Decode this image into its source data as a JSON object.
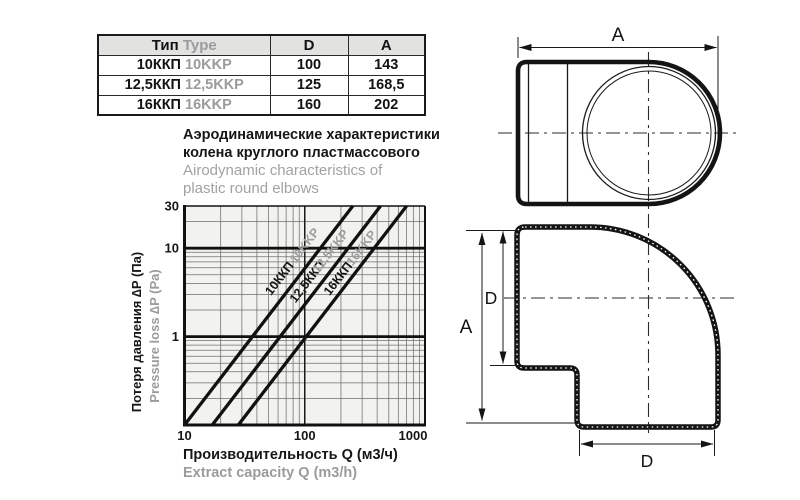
{
  "table": {
    "headers": {
      "type_ru": "Тип",
      "type_en": "Type",
      "d": "D",
      "a": "A"
    },
    "rows": [
      {
        "type_ru": "10ККП",
        "type_en": "10KKP",
        "d": "100",
        "a": "143"
      },
      {
        "type_ru": "12,5ККП",
        "type_en": "12,5KKP",
        "d": "125",
        "a": "168,5"
      },
      {
        "type_ru": "16ККП",
        "type_en": "16KKP",
        "d": "160",
        "a": "202"
      }
    ]
  },
  "title": {
    "ru_line1": "Аэродинамические характеристики",
    "ru_line2": "колена круглого пластмассового",
    "en_line1": "Airodynamic characteristics of",
    "en_line2": "plastic round elbows"
  },
  "chart_data": {
    "type": "line",
    "title_ru": "Аэродинамические характеристики колена круглого пластмассового",
    "title_en": "Airodynamic characteristics of plastic round elbows",
    "x_scale": "log",
    "y_scale": "log",
    "xlim": [
      10,
      1000
    ],
    "ylim": [
      0.1,
      30
    ],
    "x_ticks": [
      10,
      100,
      1000
    ],
    "y_ticks": [
      30,
      10,
      1
    ],
    "grid": "log minor gridlines on both axes, heavy rules at P=1 and P=10",
    "xlabel_ru": "Производительность Q (м3/ч)",
    "xlabel_en": "Extract capacity Q (m3/h)",
    "ylabel_ru": "Потеря давления ∆P (Па)",
    "ylabel_en": "Pressure loss ∆P (Pa)",
    "legend_position": "labels rotated along lines",
    "series": [
      {
        "name_ru": "10ККП",
        "name_en": "10KKP",
        "points": [
          [
            10,
            0.1
          ],
          [
            251,
            30
          ]
        ]
      },
      {
        "name_ru": "12,5ККП",
        "name_en": "12,5KKP",
        "points": [
          [
            17,
            0.1
          ],
          [
            427,
            30
          ]
        ]
      },
      {
        "name_ru": "16ККП",
        "name_en": "16KKP",
        "points": [
          [
            28,
            0.1
          ],
          [
            703,
            30
          ]
        ]
      }
    ]
  },
  "drawings": {
    "top_view": {
      "dim_a": "A"
    },
    "side_view": {
      "dim_a": "A",
      "dim_d_inlet": "D",
      "dim_d_outlet": "D"
    }
  },
  "colors": {
    "ink": "#141414",
    "muted_gray": "#9b9b9b",
    "table_header_bg": "#e2e2e1",
    "plot_bg": "#f2f2ef",
    "grid_minor": "#6f6f6f"
  }
}
